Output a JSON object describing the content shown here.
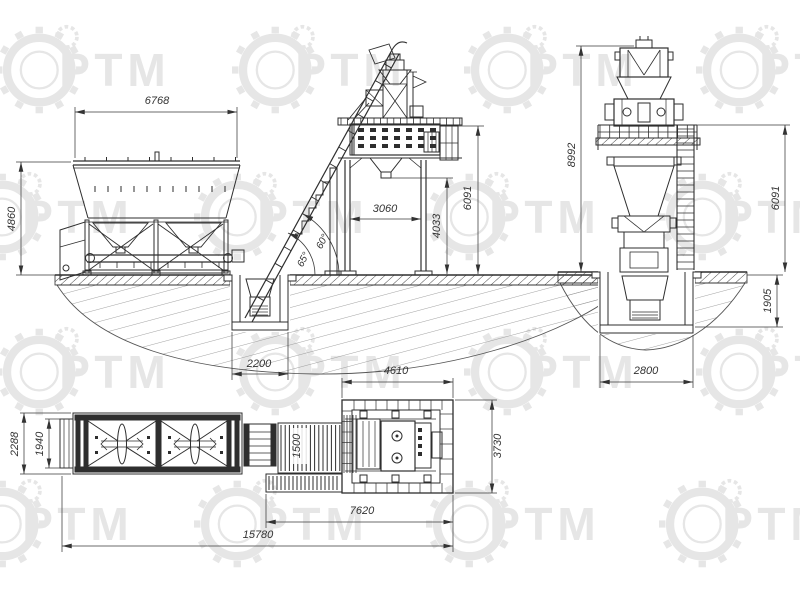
{
  "drawing": {
    "title": "concrete-batching-plant-general-views",
    "watermark": {
      "text": "РТМ"
    },
    "line_color": "#2e2e2e",
    "dim_color": "#333333",
    "watermark_color": "#e6e6e6",
    "views": {
      "side": {
        "dims": {
          "bins_length": "6768",
          "bins_height": "4860",
          "legs_span": "3060",
          "discharge_height": "4033",
          "platform_height": "6091",
          "skip_pit_width": "2200",
          "skip_angle_upper": "60°",
          "skip_angle_lower": "65°"
        }
      },
      "end": {
        "dims": {
          "total_height": "8992",
          "platform_height": "6091",
          "pit_depth": "1905",
          "pit_width": "2800"
        }
      },
      "plan": {
        "dims": {
          "bins_width": "2288",
          "bins_inner_width": "1940",
          "skip_belt_width": "1500",
          "mixer_frame_length": "4610",
          "mixer_frame_width": "3730",
          "conveyor_length": "7620",
          "total_length": "15780"
        }
      }
    }
  }
}
